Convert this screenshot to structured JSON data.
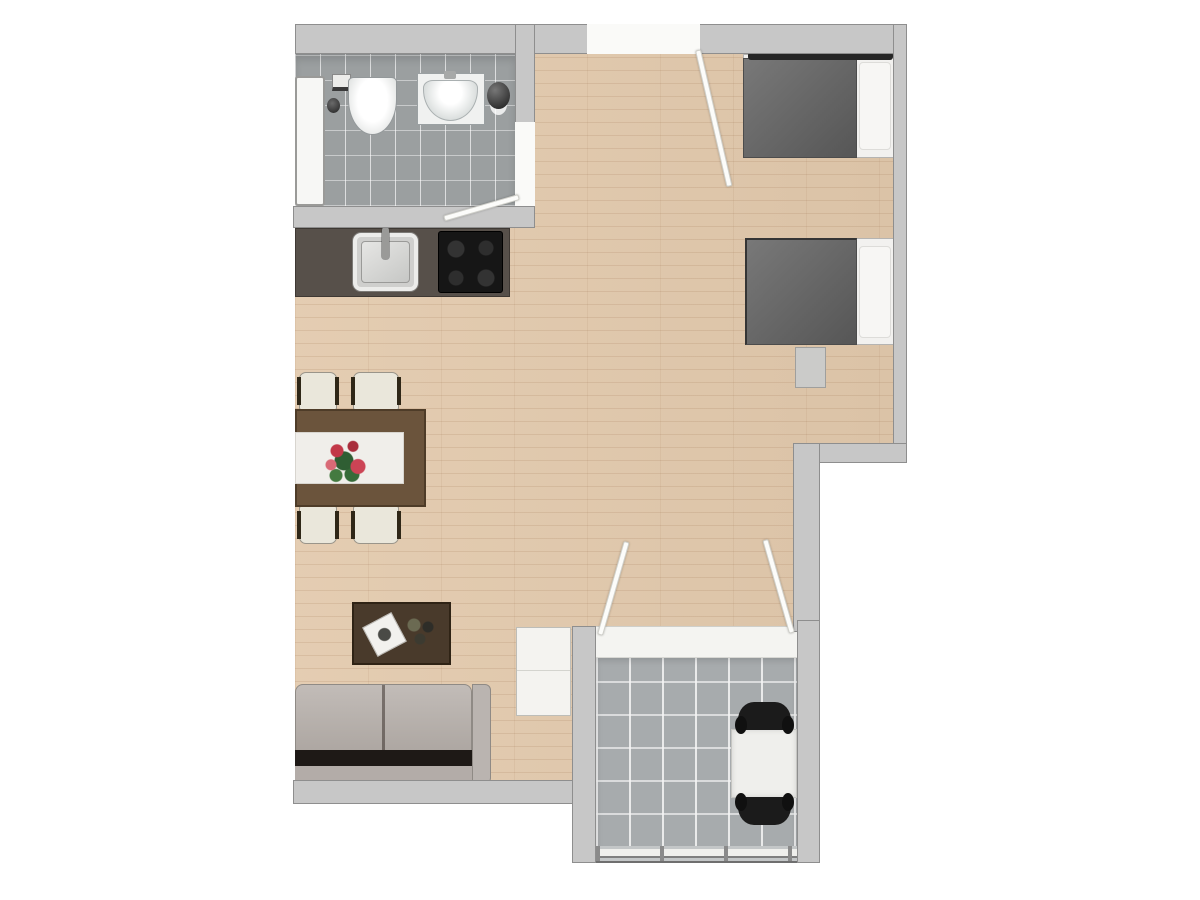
{
  "floorplan": {
    "type": "apartment-top-view",
    "rooms": [
      "bathroom",
      "kitchen",
      "dining-area",
      "living-area",
      "sleeping-area",
      "entry",
      "balcony"
    ],
    "doors": [
      "entrance-door",
      "bathroom-door",
      "balcony-double-door"
    ],
    "furniture": [
      "bathtub",
      "toilet",
      "washbasin",
      "dark-vessel-sink",
      "kitchen-sink",
      "cooktop",
      "dining-table",
      "table-runner",
      "flower-bouquet",
      "dining-chair-x4",
      "coffee-table",
      "tray",
      "sofa",
      "side-cabinet",
      "bed-x2",
      "pillow-x2",
      "bedside-stool",
      "balcony-table",
      "balcony-chair-x2",
      "railing"
    ],
    "colors": {
      "background": "#ffffff",
      "wall": "#c7c7c7",
      "wall_edge": "#8e8e8e",
      "wood_floor": "#e2c9ac",
      "bathroom_tile": "#9b9fa0",
      "balcony_tile": "#a7abad",
      "door_leaf": "#fcfcfa",
      "threshold": "#f4f4f1",
      "counter": "#57504a",
      "cooktop": "#161616",
      "sink_steel": "#cfcfcd",
      "dining_table": "#6b543c",
      "table_runner": "#f0eeea",
      "flower_red": "#c23848",
      "flower_green": "#2f5e33",
      "chair_seat": "#eae7db",
      "chair_frame": "#2f2717",
      "coffee_table": "#493a2b",
      "sofa_cushion": "#b7b0ab",
      "sofa_gap": "#1e1916",
      "sofa_frame": "#bab4b0",
      "cabinet": "#f4f3f0",
      "bed_duvet": "#696969",
      "bed_linen": "#f2f1ef",
      "bed_frame": "#262626",
      "stool": "#cbcbc9",
      "balcony_table": "#efefec",
      "balcony_chair": "#1b1b1b",
      "bathtub": "#f7f7f5",
      "toilet": "#fdfdfc",
      "vessel_dark": "#2c2c2c",
      "railing": "#c3c6c7"
    }
  }
}
